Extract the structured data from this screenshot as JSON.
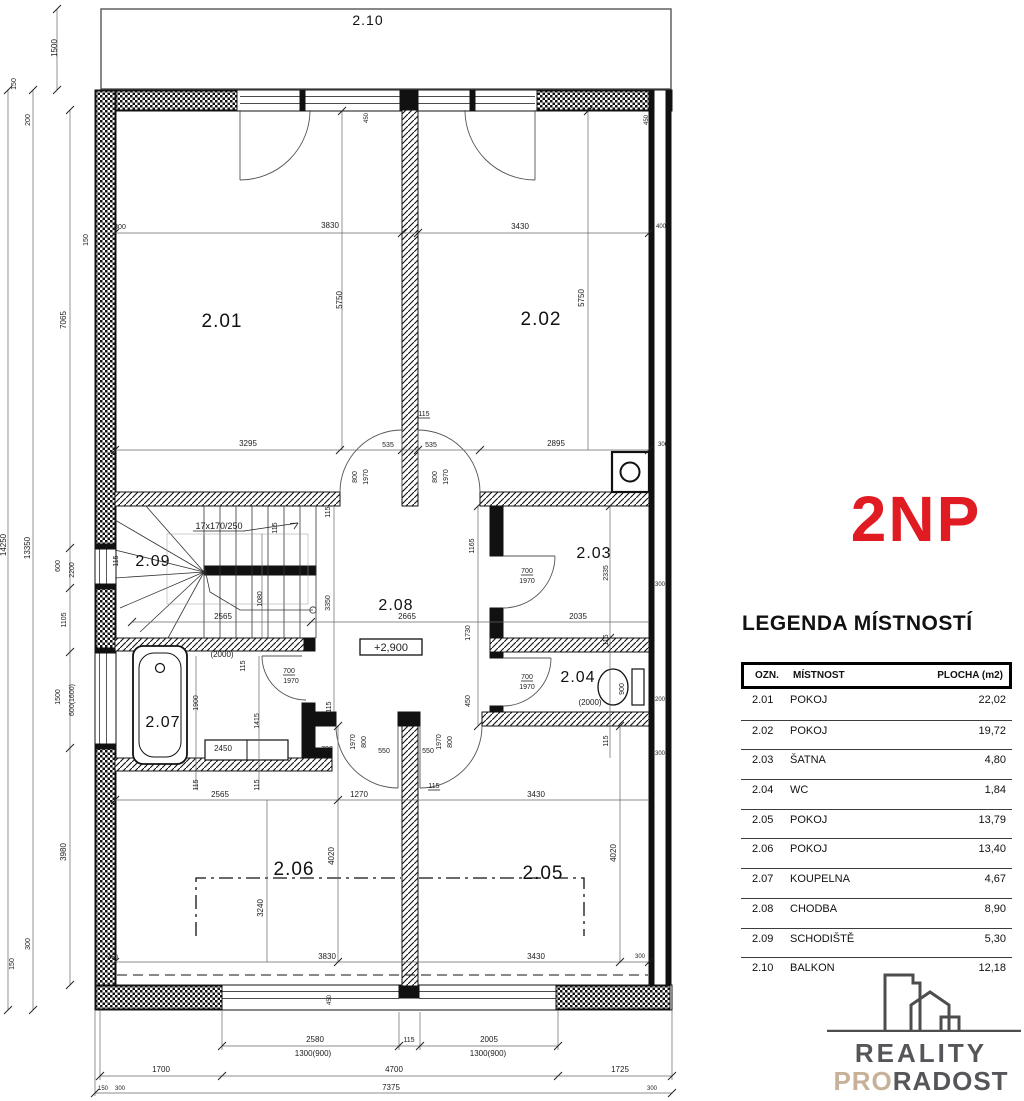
{
  "title": {
    "floor_label": "2NP"
  },
  "colors": {
    "floor_label_color": "#e11b22",
    "logo_text": "#55565a",
    "logo_accent": "#c7b299"
  },
  "legend": {
    "heading": "LEGENDA MÍSTNOSTÍ",
    "columns": {
      "ozn": "OZN.",
      "mistnost": "MÍSTNOST",
      "plocha": "PLOCHA (m2)"
    },
    "rows": [
      {
        "ozn": "2.01",
        "mistnost": "POKOJ",
        "plocha": "22,02"
      },
      {
        "ozn": "2.02",
        "mistnost": "POKOJ",
        "plocha": "19,72"
      },
      {
        "ozn": "2.03",
        "mistnost": "ŠATNA",
        "plocha": "4,80"
      },
      {
        "ozn": "2.04",
        "mistnost": "WC",
        "plocha": "1,84"
      },
      {
        "ozn": "2.05",
        "mistnost": "POKOJ",
        "plocha": "13,79"
      },
      {
        "ozn": "2.06",
        "mistnost": "POKOJ",
        "plocha": "13,40"
      },
      {
        "ozn": "2.07",
        "mistnost": "KOUPELNA",
        "plocha": "4,67"
      },
      {
        "ozn": "2.08",
        "mistnost": "CHODBA",
        "plocha": "8,90"
      },
      {
        "ozn": "2.09",
        "mistnost": "SCHODIŠTĚ",
        "plocha": "5,30"
      },
      {
        "ozn": "2.10",
        "mistnost": "BALKON",
        "plocha": "12,18"
      }
    ]
  },
  "logo": {
    "word1": "REALITY",
    "word2_accent": "PRO",
    "word2_rest": "RADOST"
  },
  "plan": {
    "room_labels": [
      {
        "t": "2.01",
        "x": 222,
        "y": 327,
        "s": 19
      },
      {
        "t": "2.02",
        "x": 541,
        "y": 325,
        "s": 19
      },
      {
        "t": "2.03",
        "x": 594,
        "y": 558,
        "s": 16
      },
      {
        "t": "2.04",
        "x": 578,
        "y": 682,
        "s": 16
      },
      {
        "t": "2.05",
        "x": 543,
        "y": 879,
        "s": 19
      },
      {
        "t": "2.06",
        "x": 294,
        "y": 875,
        "s": 19
      },
      {
        "t": "2.07",
        "x": 163,
        "y": 727,
        "s": 16
      },
      {
        "t": "2.08",
        "x": 396,
        "y": 610,
        "s": 16
      },
      {
        "t": "2.09",
        "x": 153,
        "y": 566,
        "s": 16
      },
      {
        "t": "2.10",
        "x": 368,
        "y": 25,
        "s": 14
      }
    ],
    "dim_labels": [
      {
        "t": "1500",
        "x": 57,
        "y": 48,
        "r": -90
      },
      {
        "t": "150",
        "x": 16,
        "y": 84,
        "r": -90,
        "s": 7
      },
      {
        "t": "200",
        "x": 30,
        "y": 120,
        "r": -90,
        "s": 7
      },
      {
        "t": "7065",
        "x": 66,
        "y": 320,
        "r": -90
      },
      {
        "t": "150",
        "x": 88,
        "y": 240,
        "r": -90,
        "s": 7
      },
      {
        "t": "14250",
        "x": 6,
        "y": 545,
        "r": -90
      },
      {
        "t": "13350",
        "x": 30,
        "y": 548,
        "r": -90
      },
      {
        "t": "600",
        "x": 60,
        "y": 566,
        "r": -90,
        "s": 7
      },
      {
        "t": "2200",
        "x": 74,
        "y": 570,
        "r": -90,
        "s": 7
      },
      {
        "t": "1105",
        "x": 66,
        "y": 620,
        "r": -90,
        "s": 7
      },
      {
        "t": "1500",
        "x": 60,
        "y": 697,
        "r": -90,
        "s": 7
      },
      {
        "t": "600(1600)",
        "x": 74,
        "y": 700,
        "r": -90,
        "s": 7
      },
      {
        "t": "3980",
        "x": 66,
        "y": 852,
        "r": -90
      },
      {
        "t": "300",
        "x": 30,
        "y": 944,
        "r": -90,
        "s": 7
      },
      {
        "t": "150",
        "x": 14,
        "y": 964,
        "r": -90,
        "s": 7
      },
      {
        "t": "300",
        "x": 120,
        "y": 229,
        "s": 7
      },
      {
        "t": "3830",
        "x": 330,
        "y": 228
      },
      {
        "t": "3430",
        "x": 520,
        "y": 229
      },
      {
        "t": "400",
        "x": 661,
        "y": 228,
        "s": 6
      },
      {
        "t": "450",
        "x": 368,
        "y": 118,
        "r": -90,
        "s": 6
      },
      {
        "t": "450",
        "x": 648,
        "y": 120,
        "r": -90,
        "s": 6
      },
      {
        "t": "3295",
        "x": 248,
        "y": 446
      },
      {
        "t": "535",
        "x": 388,
        "y": 447,
        "s": 7
      },
      {
        "t": "115",
        "x": 424,
        "y": 416,
        "s": 7,
        "u": 1
      },
      {
        "t": "535",
        "x": 431,
        "y": 447,
        "s": 7
      },
      {
        "t": "2895",
        "x": 556,
        "y": 446
      },
      {
        "t": "300",
        "x": 663,
        "y": 446,
        "s": 6
      },
      {
        "t": "5750",
        "x": 342,
        "y": 300,
        "r": -90
      },
      {
        "t": "5750",
        "x": 584,
        "y": 298,
        "r": -90
      },
      {
        "t": "800",
        "x": 357,
        "y": 477,
        "r": -90,
        "s": 7
      },
      {
        "t": "1970",
        "x": 368,
        "y": 477,
        "r": -90,
        "s": 7
      },
      {
        "t": "800",
        "x": 437,
        "y": 477,
        "r": -90,
        "s": 7
      },
      {
        "t": "1970",
        "x": 448,
        "y": 477,
        "r": -90,
        "s": 7
      },
      {
        "t": "17x170/250",
        "x": 219,
        "y": 529,
        "s": 9,
        "u": 1
      },
      {
        "t": "115",
        "x": 118,
        "y": 561,
        "r": -90,
        "s": 7
      },
      {
        "t": "115",
        "x": 277,
        "y": 528,
        "r": -90,
        "s": 7
      },
      {
        "t": "115",
        "x": 330,
        "y": 512,
        "r": -90,
        "s": 7
      },
      {
        "t": "1080",
        "x": 262,
        "y": 599,
        "r": -90,
        "s": 7
      },
      {
        "t": "3350",
        "x": 330,
        "y": 603,
        "r": -90,
        "s": 7
      },
      {
        "t": "2565",
        "x": 223,
        "y": 619
      },
      {
        "t": "2665",
        "x": 407,
        "y": 619
      },
      {
        "t": "1165",
        "x": 474,
        "y": 546,
        "r": -90,
        "s": 7
      },
      {
        "t": "+2,900",
        "x": 391,
        "y": 651,
        "s": 11,
        "box": 1
      },
      {
        "t": "700",
        "x": 527,
        "y": 573,
        "s": 7,
        "u": 1
      },
      {
        "t": "1970",
        "x": 527,
        "y": 583,
        "s": 7
      },
      {
        "t": "2035",
        "x": 578,
        "y": 619
      },
      {
        "t": "2335",
        "x": 608,
        "y": 573,
        "r": -90,
        "s": 7
      },
      {
        "t": "115",
        "x": 608,
        "y": 640,
        "r": -90,
        "s": 7
      },
      {
        "t": "300",
        "x": 660,
        "y": 586,
        "s": 6
      },
      {
        "t": "700",
        "x": 527,
        "y": 679,
        "s": 7,
        "u": 1
      },
      {
        "t": "1970",
        "x": 527,
        "y": 689,
        "s": 7
      },
      {
        "t": "900",
        "x": 624,
        "y": 689,
        "r": -90,
        "s": 7
      },
      {
        "t": "(2000)",
        "x": 590,
        "y": 705,
        "s": 8
      },
      {
        "t": "200",
        "x": 660,
        "y": 701,
        "s": 6
      },
      {
        "t": "300",
        "x": 660,
        "y": 755,
        "s": 6
      },
      {
        "t": "115",
        "x": 608,
        "y": 741,
        "r": -90,
        "s": 7
      },
      {
        "t": "(2000)",
        "x": 222,
        "y": 657,
        "s": 8
      },
      {
        "t": "115",
        "x": 245,
        "y": 666,
        "r": -90,
        "s": 7
      },
      {
        "t": "700",
        "x": 289,
        "y": 673,
        "s": 7,
        "u": 1
      },
      {
        "t": "1970",
        "x": 291,
        "y": 683,
        "s": 7
      },
      {
        "t": "1900",
        "x": 198,
        "y": 703,
        "r": -90,
        "s": 7
      },
      {
        "t": "1415",
        "x": 259,
        "y": 721,
        "r": -90,
        "s": 7
      },
      {
        "t": "2450",
        "x": 223,
        "y": 751
      },
      {
        "t": "720",
        "x": 327,
        "y": 751,
        "s": 7
      },
      {
        "t": "115",
        "x": 198,
        "y": 785,
        "r": -90,
        "s": 7
      },
      {
        "t": "115",
        "x": 259,
        "y": 785,
        "r": -90,
        "s": 7
      },
      {
        "t": "115",
        "x": 331,
        "y": 707,
        "r": -90,
        "s": 7
      },
      {
        "t": "2565",
        "x": 220,
        "y": 797
      },
      {
        "t": "1970",
        "x": 355,
        "y": 742,
        "r": -90,
        "s": 7
      },
      {
        "t": "800",
        "x": 366,
        "y": 742,
        "r": -90,
        "s": 7
      },
      {
        "t": "1970",
        "x": 441,
        "y": 742,
        "r": -90,
        "s": 7
      },
      {
        "t": "800",
        "x": 452,
        "y": 742,
        "r": -90,
        "s": 7
      },
      {
        "t": "550",
        "x": 384,
        "y": 753,
        "s": 7
      },
      {
        "t": "550",
        "x": 428,
        "y": 753,
        "s": 7
      },
      {
        "t": "115",
        "x": 434,
        "y": 788,
        "s": 7,
        "u": 1
      },
      {
        "t": "450",
        "x": 470,
        "y": 701,
        "r": -90,
        "s": 7
      },
      {
        "t": "1730",
        "x": 470,
        "y": 633,
        "r": -90,
        "s": 7
      },
      {
        "t": "1270",
        "x": 359,
        "y": 797
      },
      {
        "t": "3430",
        "x": 536,
        "y": 797
      },
      {
        "t": "4020",
        "x": 334,
        "y": 856,
        "r": -90
      },
      {
        "t": "4020",
        "x": 616,
        "y": 853,
        "r": -90
      },
      {
        "t": "3240",
        "x": 263,
        "y": 908,
        "r": -90
      },
      {
        "t": "3830",
        "x": 327,
        "y": 959
      },
      {
        "t": "3430",
        "x": 536,
        "y": 959
      },
      {
        "t": "300",
        "x": 640,
        "y": 958,
        "s": 6
      },
      {
        "t": "450",
        "x": 113,
        "y": 959,
        "s": 6
      },
      {
        "t": "450",
        "x": 331,
        "y": 1000,
        "r": -90,
        "s": 6
      },
      {
        "t": "2580",
        "x": 315,
        "y": 1042
      },
      {
        "t": "1300(900)",
        "x": 313,
        "y": 1056
      },
      {
        "t": "115",
        "x": 409,
        "y": 1042,
        "s": 7
      },
      {
        "t": "2005",
        "x": 489,
        "y": 1042
      },
      {
        "t": "1300(900)",
        "x": 488,
        "y": 1056
      },
      {
        "t": "1700",
        "x": 161,
        "y": 1072
      },
      {
        "t": "4700",
        "x": 394,
        "y": 1072
      },
      {
        "t": "1725",
        "x": 620,
        "y": 1072
      },
      {
        "t": "150",
        "x": 103,
        "y": 1090,
        "s": 6
      },
      {
        "t": "300",
        "x": 120,
        "y": 1090,
        "s": 6
      },
      {
        "t": "7375",
        "x": 391,
        "y": 1090
      },
      {
        "t": "300",
        "x": 652,
        "y": 1090,
        "s": 6
      }
    ]
  }
}
